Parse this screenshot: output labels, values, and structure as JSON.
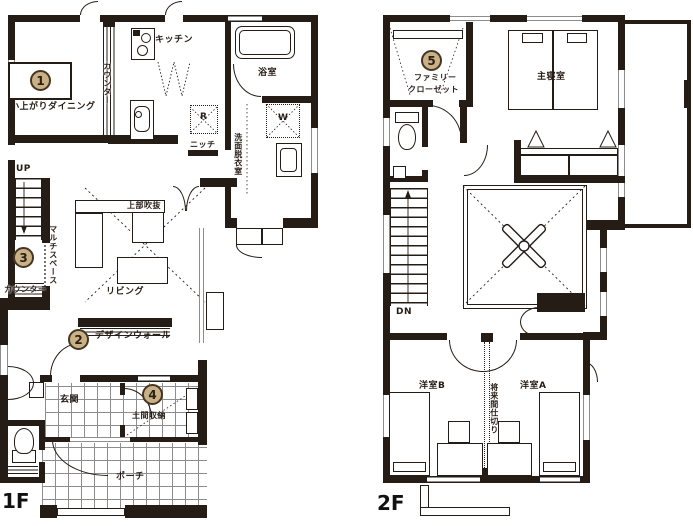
{
  "title": "二階建て間取り図 (1F / 2F floor plan)",
  "colors": {
    "wall": "#261c16",
    "badge_fill": "#c9b185",
    "badge_border": "#453523",
    "tile_line": "#8d8d8d"
  },
  "badges": {
    "b1": "1",
    "b2": "2",
    "b3": "3",
    "b4": "4",
    "b5": "5"
  },
  "floor1": {
    "label": "1F",
    "rooms": {
      "dining": "小上がりダイニング",
      "kitchen": "キッチン",
      "kitchen_counter": "カウンター",
      "bath": "浴室",
      "laundry": "洗面脱衣室",
      "niche": "ニッチ",
      "fridge": "R",
      "washer": "W",
      "stairs_up": "UP",
      "multi_space": "マルチスペース",
      "counter": "カウンター",
      "living": "リビング",
      "upper_void": "上部吹抜",
      "design_wall": "デザインウォール",
      "entrance": "玄関",
      "doma_storage": "土間収納",
      "porch": "ポーチ"
    }
  },
  "floor2": {
    "label": "2F",
    "rooms": {
      "family_closet_1": "ファミリー",
      "family_closet_2": "クローゼット",
      "master_bedroom": "主寝室",
      "stairs_down": "DN",
      "room_b": "洋室B",
      "room_a": "洋室A",
      "future_partition": "将来間仕切り"
    }
  }
}
